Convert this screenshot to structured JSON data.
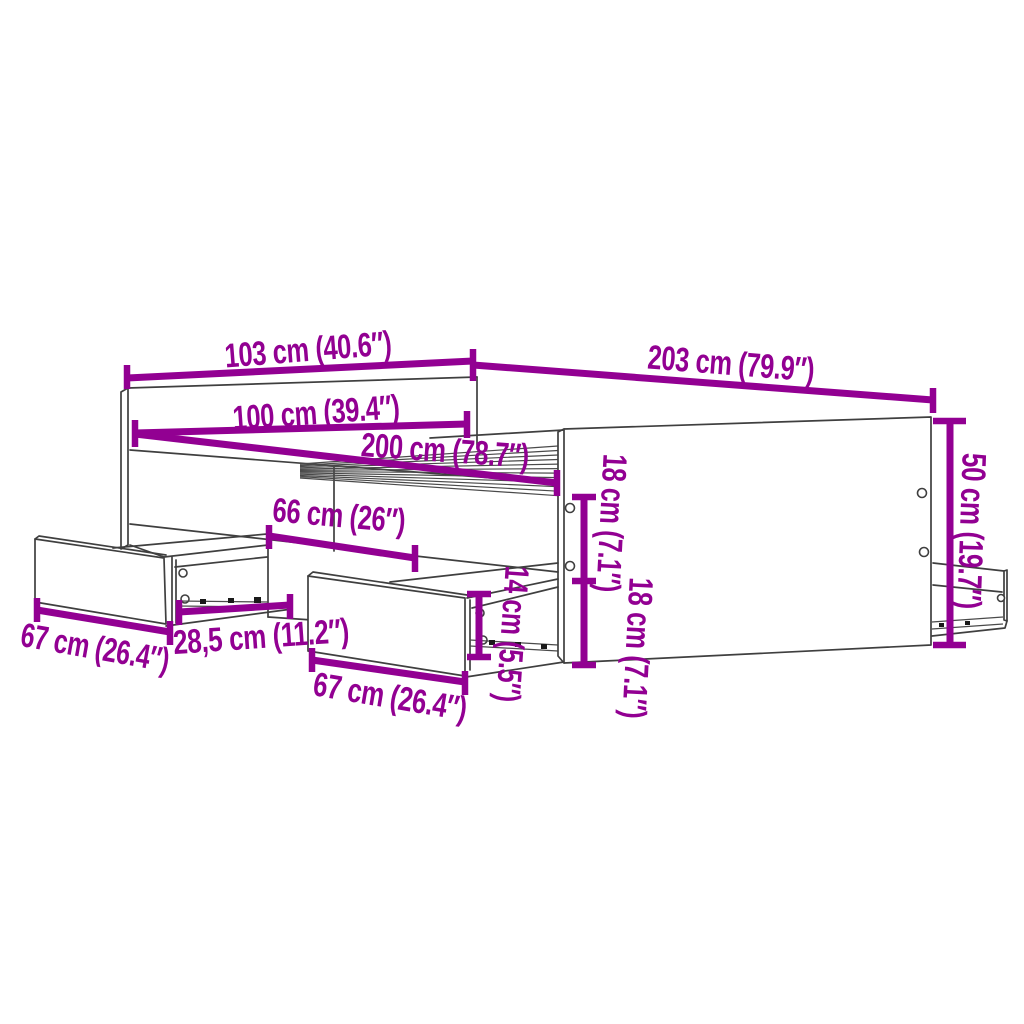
{
  "diagram": {
    "subject": "bed frame with storage drawers - product dimension diagram",
    "colors": {
      "annotation": "#920092",
      "outline": "#3f3f3f",
      "background": "#ffffff"
    },
    "dimensions": [
      {
        "id": "headboard-width",
        "label": "103 cm (40.6″)"
      },
      {
        "id": "frame-length",
        "label": "203 cm (79.9″)"
      },
      {
        "id": "mattress-width",
        "label": "100 cm (39.4″)"
      },
      {
        "id": "mattress-length",
        "label": "200 cm (78.7″)"
      },
      {
        "id": "drawer-opening-width",
        "label": "66 cm (26″)"
      },
      {
        "id": "drawer-extension",
        "label": "28,5 cm (11.2″)"
      },
      {
        "id": "left-drawer-width",
        "label": "67 cm (26.4″)"
      },
      {
        "id": "center-drawer-width",
        "label": "67 cm (26.4″)"
      },
      {
        "id": "drawer-height",
        "label": "14 cm (5.5″)"
      },
      {
        "id": "upper-rail-height",
        "label": "18 cm (7.1″)"
      },
      {
        "id": "lower-rail-height",
        "label": "18 cm (7.1″)"
      },
      {
        "id": "footboard-height",
        "label": "50 cm (19.7″)"
      }
    ]
  }
}
